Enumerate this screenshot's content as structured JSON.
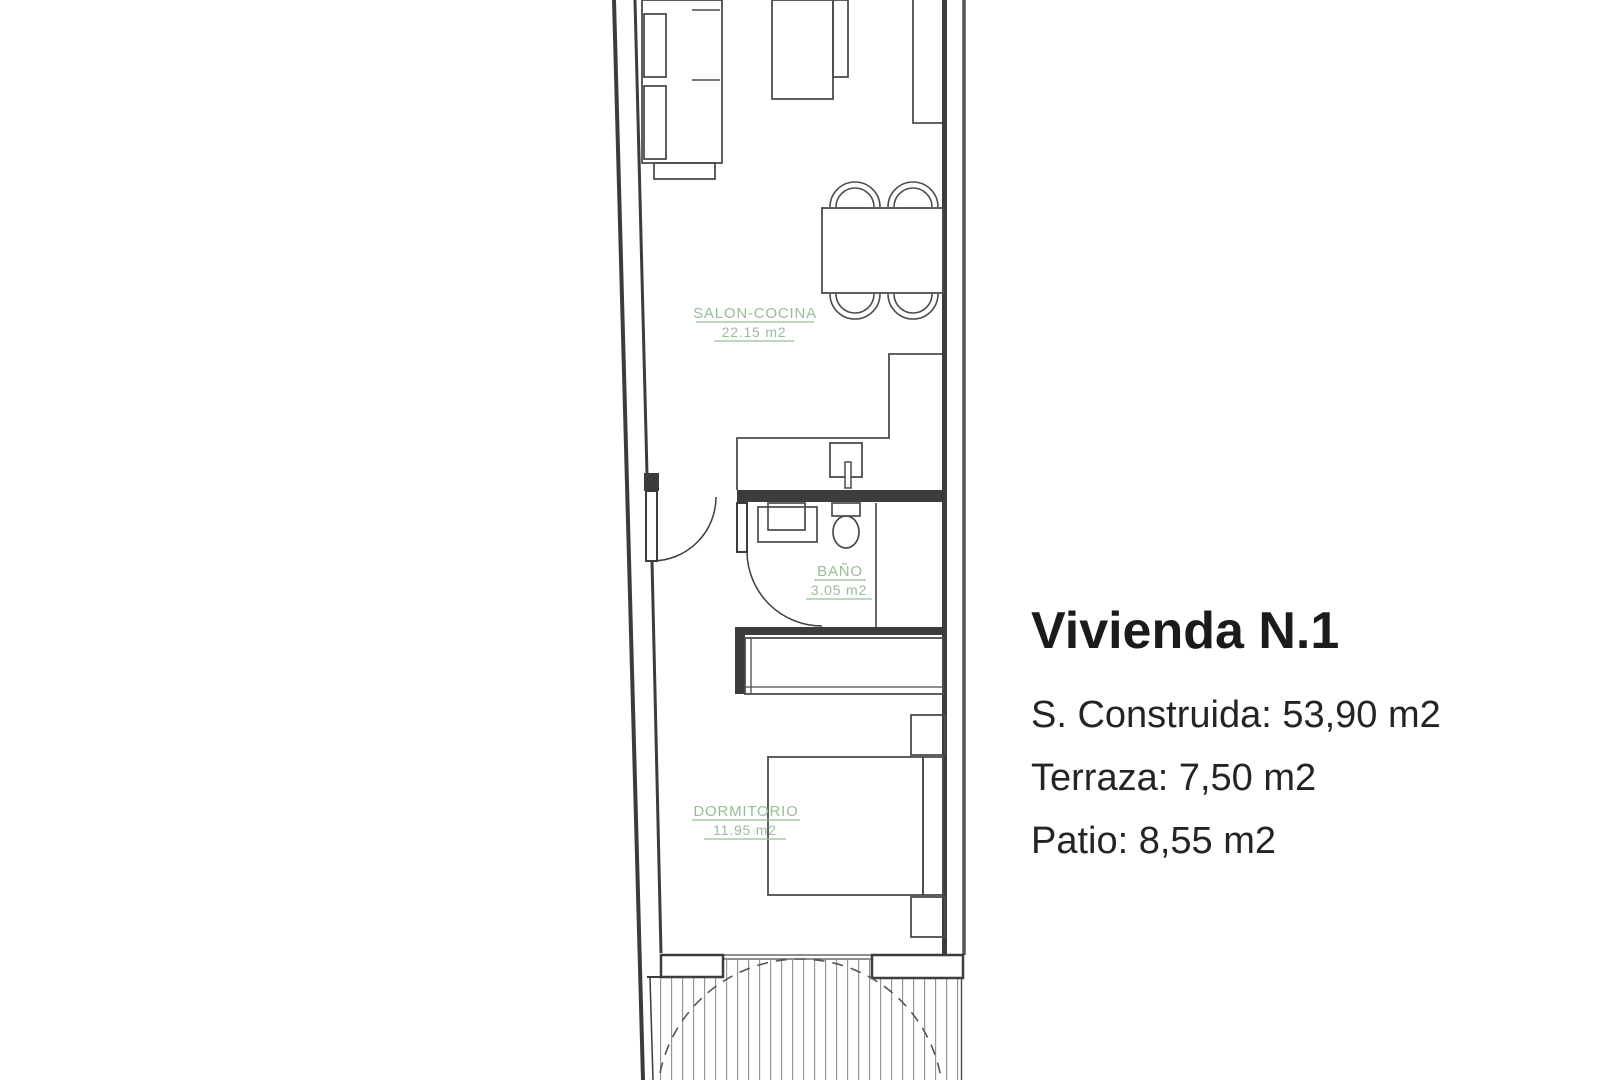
{
  "floor_plan": {
    "unit": "Vivienda N.1",
    "rooms": [
      {
        "name": "SALON-COCINA",
        "area": "22.15 m2"
      },
      {
        "name": "BAÑO",
        "area": "3.05 m2"
      },
      {
        "name": "DORMITORIO",
        "area": "11.95 m2"
      }
    ],
    "colors": {
      "wall_line": "#3c3c3c",
      "furniture_line": "#4c4c4c",
      "room_label_green": "#99bd97",
      "hatch_gray": "#8f8f8f"
    }
  },
  "info_panel": {
    "title": "Vivienda N.1",
    "details": [
      "S. Construida: 53,90 m2",
      "Terraza: 7,50 m2",
      "Patio: 8,55 m2"
    ]
  }
}
